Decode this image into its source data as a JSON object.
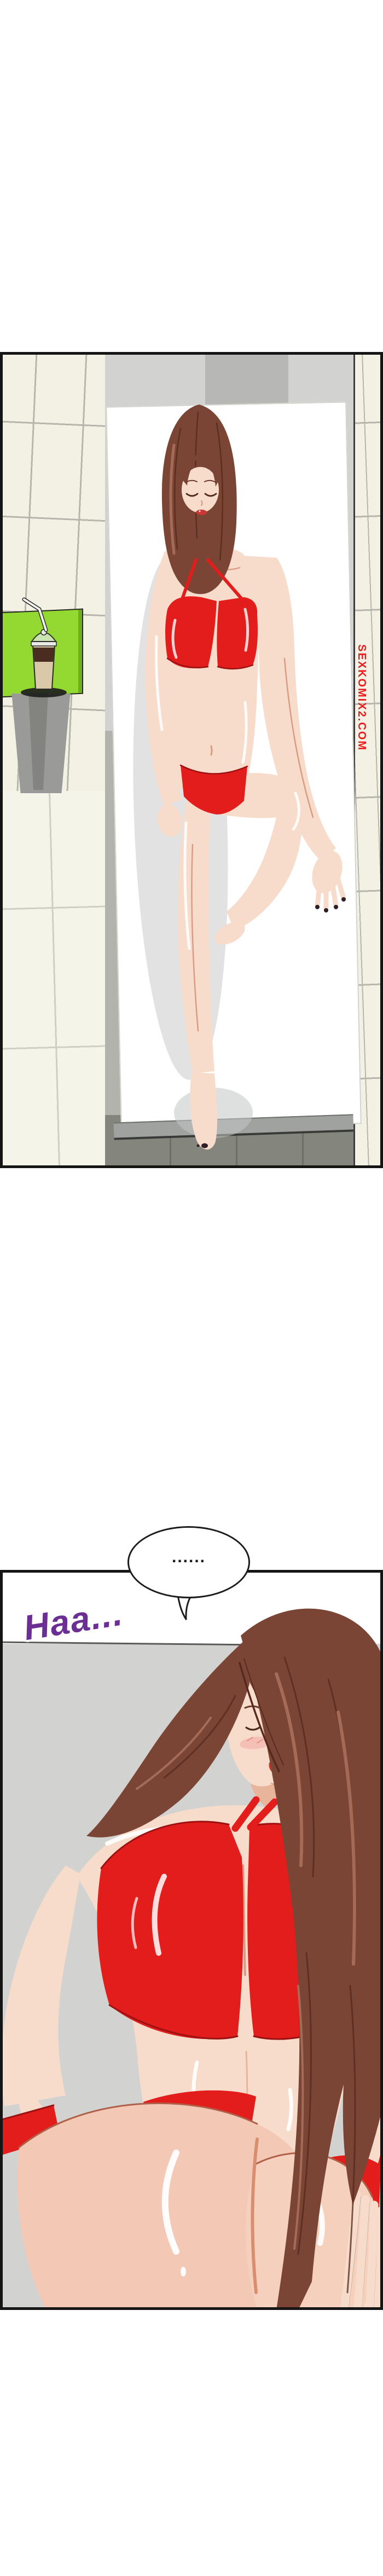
{
  "colors": {
    "page-bg": "#ffffff",
    "panel-border": "#151515",
    "tile-cream": "#f2f1e3",
    "tile-floor": "#f5f4e8",
    "tile-grout": "#b6b6ac",
    "wall-gray": "#d2d3d1",
    "wall-gray-dark": "#b7b8b6",
    "floor-gray": "#b2b3ad",
    "floor-dark": "#84857c",
    "table-green": "#94d832",
    "table-leg-gray": "#9a9b99",
    "mat-white": "#ffffff",
    "mat-edge": "#a0a29f",
    "skin": "#f7dbcb",
    "skin-warm": "#f3c9b6",
    "skin-shade": "#d99c82",
    "skin-line": "#b06048",
    "hair-brown": "#7b4536",
    "hair-dark": "#56281e",
    "hair-light": "#a8705c",
    "bikini-red": "#e31c1c",
    "bikini-red-dark": "#9c1212",
    "lips-red": "#c93734",
    "nail-dark": "#2f1d28",
    "blush-pink": "#f2a5a0",
    "bubble-outline": "#1c1c1c",
    "sfx-purple": "#6b2e93",
    "watermark-red": "#ee1a1a",
    "liquid-brown": "#4a2d20",
    "cup-tan": "#d9c9a8",
    "lid-green": "#cfe4bd"
  },
  "speech_bubble": {
    "text": "......"
  },
  "sfx": {
    "text": "Haa..."
  },
  "watermark": {
    "text": "SEXKOMIX2.COM"
  }
}
